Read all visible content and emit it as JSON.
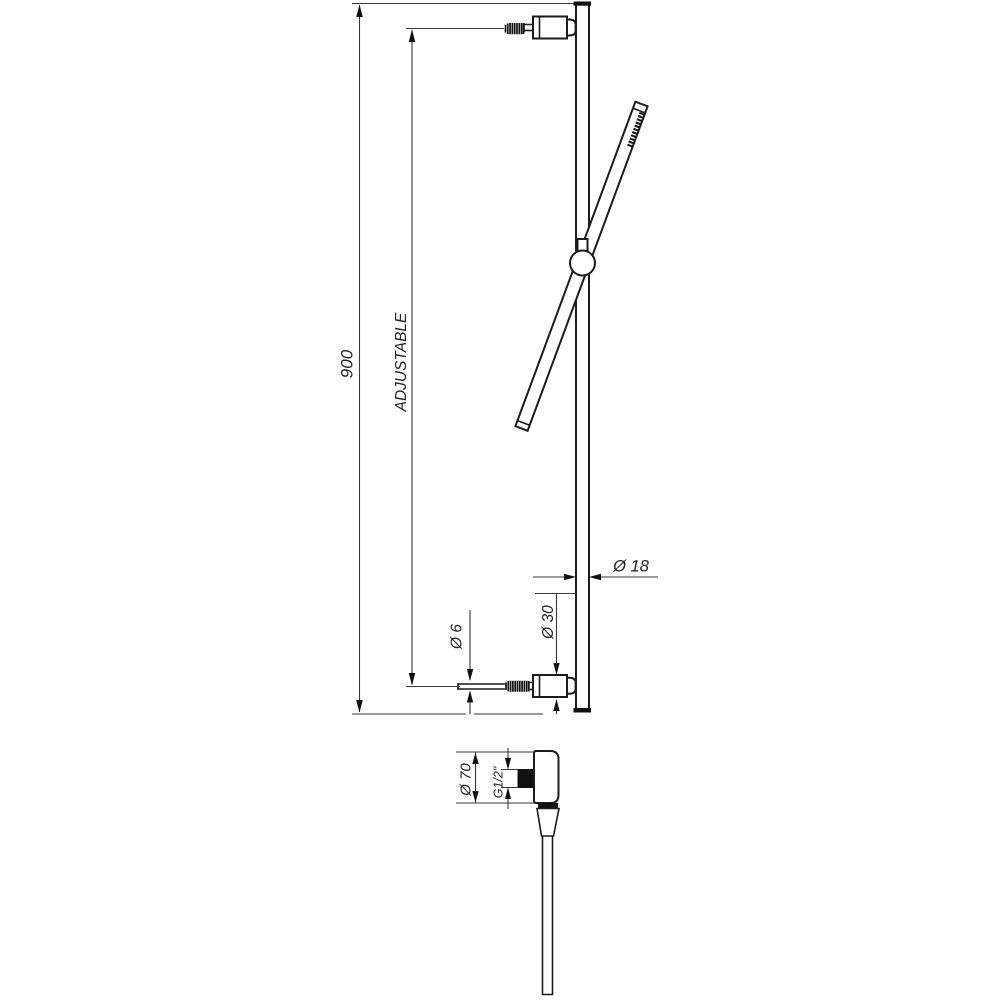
{
  "drawing": {
    "type": "technical-drawing",
    "subject": "shower slide rail with hand shower and wall outlet",
    "colors": {
      "background": "#ffffff",
      "object_line": "#1c1c1c",
      "dimension_line": "#3a3a3a",
      "text": "#222222"
    },
    "dimensions": {
      "overall_height": "900",
      "adjustable_label": "ADJUSTABLE",
      "rail_diameter": "Ø 18",
      "screw_diameter": "Ø 6",
      "bracket_diameter": "Ø 30",
      "flange_diameter": "Ø 70",
      "thread_size": "G1/2\""
    }
  }
}
